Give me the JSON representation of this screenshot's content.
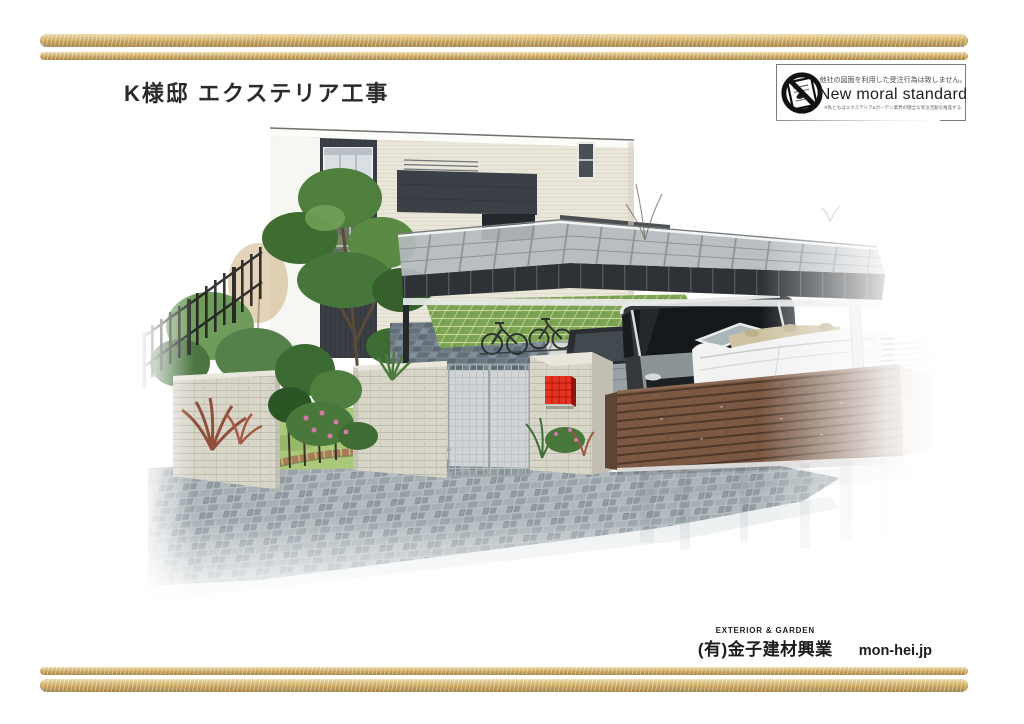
{
  "header": {
    "title": "K様邸 エクステリア工事"
  },
  "moral_badge": {
    "icon": "no-copy-blueprint-icon",
    "top_text": "他社の図面を利用した受注行為は致しません。",
    "main_text": "New moral standard",
    "bottom_text": "※私どもはエクステリア&ガーデン業界の健全な受注活動を推進するキャンペーンに賛同しています。"
  },
  "footer": {
    "tagline": "EXTERIOR & GARDEN",
    "company": "(有)金子建材興業",
    "website": "mon-hei.jp"
  },
  "colors": {
    "decor_bar": "#c9a55c",
    "title_text": "#2a2a2a",
    "badge_border": "#7a7a7a",
    "mailbox_red": "#e53222",
    "wood_fence": "#7a5843",
    "stone_wall": "#d8d5c9",
    "lawn_green": "#7da355",
    "paving_gray": "#9aa6ab",
    "house_wall": "#e9e6d9",
    "house_accent": "#3a3f45",
    "roof_gray": "#b5babe"
  }
}
